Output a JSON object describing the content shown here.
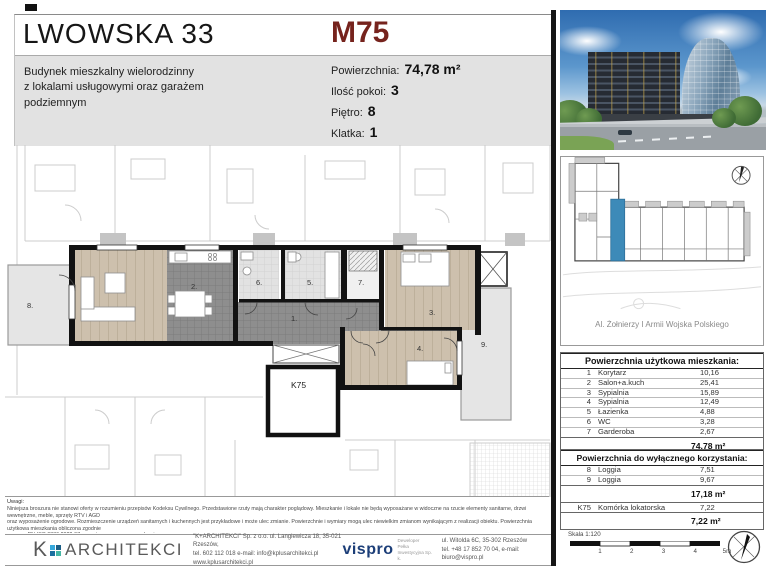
{
  "accent_color": "#76231d",
  "highlight_color": "#3d8ab8",
  "header": {
    "title": "LWOWSKA 33",
    "unit_id": "M75",
    "subtitle_lines": [
      "Budynek mieszkalny wielorodzinny",
      "z lokalami usługowymi oraz garażem",
      "podziemnym"
    ],
    "details": [
      {
        "label": "Powierzchnia:",
        "value": "74,78 m²"
      },
      {
        "label": "Ilość pokoi:",
        "value": "3"
      },
      {
        "label": "Piętro:",
        "value": "8"
      },
      {
        "label": "Klatka:",
        "value": "1"
      }
    ]
  },
  "floor_plan": {
    "labels": {
      "r1": "1.",
      "r2": "2.",
      "r3": "3.",
      "r4": "4.",
      "r5": "5.",
      "r6": "6.",
      "r7": "7.",
      "r8": "8.",
      "r9": "9.",
      "k75": "K75"
    }
  },
  "site_plan": {
    "street": "Al. Żołnierzy I Armii Wojska Polskiego"
  },
  "area_tables": {
    "usable": {
      "title": "Powierzchnia użytkowa mieszkania:",
      "rows": [
        {
          "no": "1",
          "name": "Korytarz",
          "area": "10,16"
        },
        {
          "no": "2",
          "name": "Salon+a.kuch",
          "area": "25,41"
        },
        {
          "no": "3",
          "name": "Sypialnia",
          "area": "15,89"
        },
        {
          "no": "4",
          "name": "Sypialnia",
          "area": "12,49"
        },
        {
          "no": "5",
          "name": "Łazienka",
          "area": "4,88"
        },
        {
          "no": "6",
          "name": "WC",
          "area": "3,28"
        },
        {
          "no": "7",
          "name": "Garderoba",
          "area": "2,67"
        }
      ],
      "total": "74,78 m²"
    },
    "exclusive": {
      "title": "Powierzchnia do wyłącznego korzystania:",
      "rows": [
        {
          "no": "8",
          "name": "Loggia",
          "area": "7,51"
        },
        {
          "no": "9",
          "name": "Loggia",
          "area": "9,67"
        }
      ],
      "subtotal": "17,18 m²",
      "cellar_row": {
        "no": "K75",
        "name": "Komórka lokatorska",
        "area": "7,22"
      },
      "cellar_total": "7,22 m²"
    }
  },
  "scale_bar": {
    "label": "Skala 1:120",
    "ticks": [
      "1",
      "2",
      "3",
      "4",
      "5m"
    ]
  },
  "notes": {
    "heading": "Uwagi:",
    "lines": [
      "Niniejsza broszura nie stanowi oferty w rozumieniu przepisów Kodeksu Cywilnego. Przedstawione rzuty mają charakter poglądowy. Mieszkanie i lokale nie będą wyposażane w widoczne na rzucie elementy sanitarne, drzwi wewnętrzne, meble, sprzęty RTV i AGD",
      "oraz wyposażenie ogrodowe. Rozmieszczenie urządzeń sanitarnych i kuchennych jest przykładowe i może ulec zmianie. Powierzchnie i wymiary mogą ulec niewielkim zmianom wynikającym z realizacji obiektu. Powierzchnia użytkowa mieszkania obliczona zgodnie",
      "z normą PN-ISO 9836:2022-07 oraz stosownym rozporządzeniem.",
      "Powierzchnię loggii i tarasów zmierzono umownie do wewnętrznej krawędzi pochwytu balustrady.",
      "Niniejsza wizualizacja budynku nie stanowi oferty w rozumieniu przepisów Kodeksu Cywilnego. Przedstawiona wizualizacja ma charakter poglądowy, wygląd budynku i przyjęte rozwiązania techniczne mogą ulec niewielkim zmianom wynikającym z realizacji obiektu."
    ]
  },
  "footer": {
    "architect": {
      "logo_k": "K",
      "logo_text": "ARCHITEKCI",
      "lines": [
        "\"K+ARCHITEKCI\" Sp. z o.o. ul. Langiewicza 18, 35-021 Rzeszów,",
        "tel. 602 112 018 e-mail: info@kplusarchitekci.pl",
        "www.kplusarchitekci.pl"
      ]
    },
    "developer": {
      "logo_text": "vispro",
      "tagline_lines": [
        "Deweloper",
        "Pełka Inwestycyjna Sp. k."
      ],
      "lines": [
        "ul. Witolda 6C, 35-302 Rzeszów",
        "tel. +48 17 852 70 04, e-mail: biuro@vispro.pl"
      ]
    }
  }
}
